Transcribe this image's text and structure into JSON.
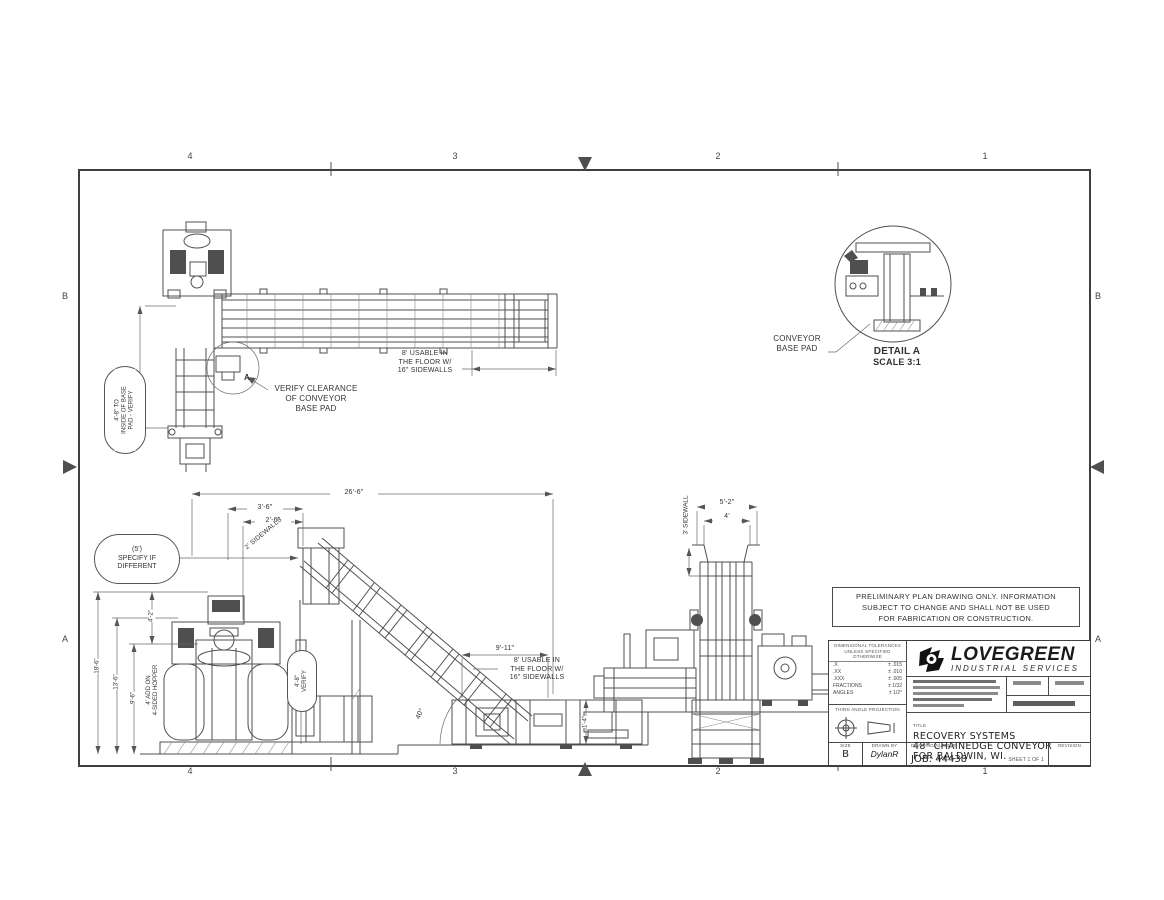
{
  "border": {
    "top": [
      "4",
      "3",
      "2",
      "1"
    ],
    "bottom": [
      "4",
      "3",
      "2",
      "1"
    ],
    "left": [
      "B",
      "A"
    ],
    "right": [
      "B",
      "A"
    ]
  },
  "plan": {
    "balloon": [
      "4'-8\" TO",
      "INSIDE OF BASE",
      "PAD - VERIFY"
    ],
    "verify": [
      "VERIFY CLEARANCE",
      "OF CONVEYOR",
      "BASE PAD"
    ],
    "usable": [
      "8' USABLE IN",
      "THE FLOOR W/",
      "16\" SIDEWALLS"
    ],
    "detail_letter": "A"
  },
  "detail": {
    "label": [
      "CONVEYOR",
      "BASE PAD"
    ],
    "title": "DETAIL A",
    "scale": "SCALE 3:1"
  },
  "elev": {
    "dim_overall": "26'-6\"",
    "dim_36": "3'-6\"",
    "dim_26": "2'-6\"",
    "balloon": [
      "(5')",
      "SPECIFY IF",
      "DIFFERENT"
    ],
    "dim_186": "18'-6\"",
    "dim_136": "13'-6\"",
    "dim_96": "9'-6\"",
    "dim_42": "4'-2\"",
    "addon": [
      "4' ADD ON",
      "4-SIDED HOPPER"
    ],
    "oval": [
      "4'-8\"",
      "VERIFY"
    ],
    "angle": "40°",
    "dim_911": "9'-11\"",
    "usable": [
      "8' USABLE IN",
      "THE FLOOR W/",
      "16\" SIDEWALLS"
    ],
    "dim_pit": "1'-4\"",
    "sidewall": "2' SIDEWALLS"
  },
  "endview": {
    "dim_52": "5'-2\"",
    "dim_4": "4'",
    "sidewall": "3' SIDEWALL"
  },
  "notes": {
    "lines": [
      "PRELIMINARY PLAN DRAWING ONLY.  INFORMATION",
      "SUBJECT TO CHANGE AND SHALL NOT BE USED",
      "FOR FABRICATION OR CONSTRUCTION."
    ]
  },
  "titleblock": {
    "tol_header": [
      "DIMENSIONAL TOLERANCES",
      "UNLESS SPECIFIED",
      "OTHERWISE"
    ],
    "tol_rows": [
      [
        ".X",
        "± .015"
      ],
      [
        ".XX",
        "± .010"
      ],
      [
        ".XXX",
        "± .005"
      ],
      [
        "FRACTIONS",
        "± 1/32"
      ],
      [
        "ANGLES",
        "± 1/2°"
      ]
    ],
    "projection_label": "THIRD ANGLE PROJECTION",
    "company": "LOVEGREEN",
    "company_sub": "INDUSTRIAL SERVICES",
    "title_label": "TITLE",
    "title_lines": [
      "RECOVERY SYSTEMS",
      "48\" CHAINEDGE CONVEYOR",
      "FOR BALDWIN, WI."
    ],
    "size_label": "SIZE",
    "size": "B",
    "drawnby_label": "DRAWN BY",
    "drawnby": "DylanR",
    "dwgno_label": "DRAWING NUMBER",
    "dwgno": "JOB: 44438",
    "sheet": "SHEET 1 OF 1",
    "revision_label": "REVISION"
  }
}
